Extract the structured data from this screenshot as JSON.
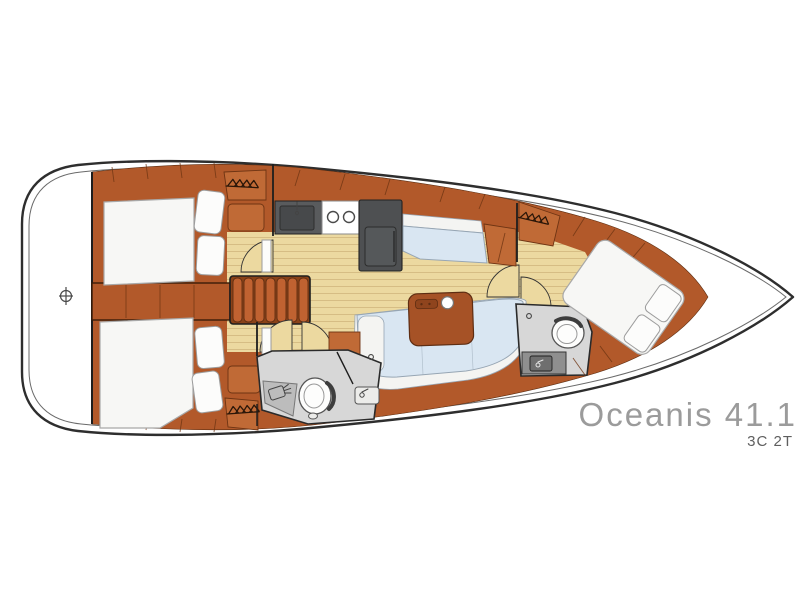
{
  "diagram": {
    "type": "yacht-deck-plan",
    "orientation": "bow-right",
    "model_label": "Oceanis 41.1",
    "configuration_label": "3C 2T"
  },
  "colors": {
    "page_bg": "#ffffff",
    "hull_outline": "#2e2e2e",
    "hull_inner": "#6a6a6a",
    "wood": "#b2592a",
    "wood_dark": "#6e3413",
    "wood_light": "#c06a36",
    "floor": "#ecd9a0",
    "plank_line": "#d6bd84",
    "bed": "#f7f7f5",
    "bed_outline": "#a8a8a8",
    "settee": "#d9e6f2",
    "settee_outline": "#97a6b4",
    "cushion_white": "#f4f4f2",
    "counter": "#595b5d",
    "appliance": "#4e5052",
    "stove": "#ffffff",
    "head_floor": "#d7d7d7",
    "shower_tray": "#bcbcbc",
    "head_outline": "#2a2a2a",
    "steps": "#c06231",
    "steps_shadow": "#8a4218",
    "table_wood": "#a65226",
    "text_model": "#9b9b9b",
    "text_config": "#5f5f5f",
    "icon_stroke": "#2a1608"
  },
  "icons": [
    {
      "name": "hanger-icon",
      "glyph": "clothes-hangers",
      "count": 3
    },
    {
      "name": "burner-icon",
      "glyph": "stove-burner-circles",
      "count": 2
    },
    {
      "name": "toilet-icon",
      "glyph": "marine-toilet",
      "count": 2
    },
    {
      "name": "shower-icon",
      "glyph": "shower-head",
      "count": 1
    },
    {
      "name": "faucet-icon",
      "glyph": "sink-faucet",
      "count": 3
    },
    {
      "name": "windlass-icon",
      "glyph": "circle-with-cross",
      "count": 1
    }
  ]
}
